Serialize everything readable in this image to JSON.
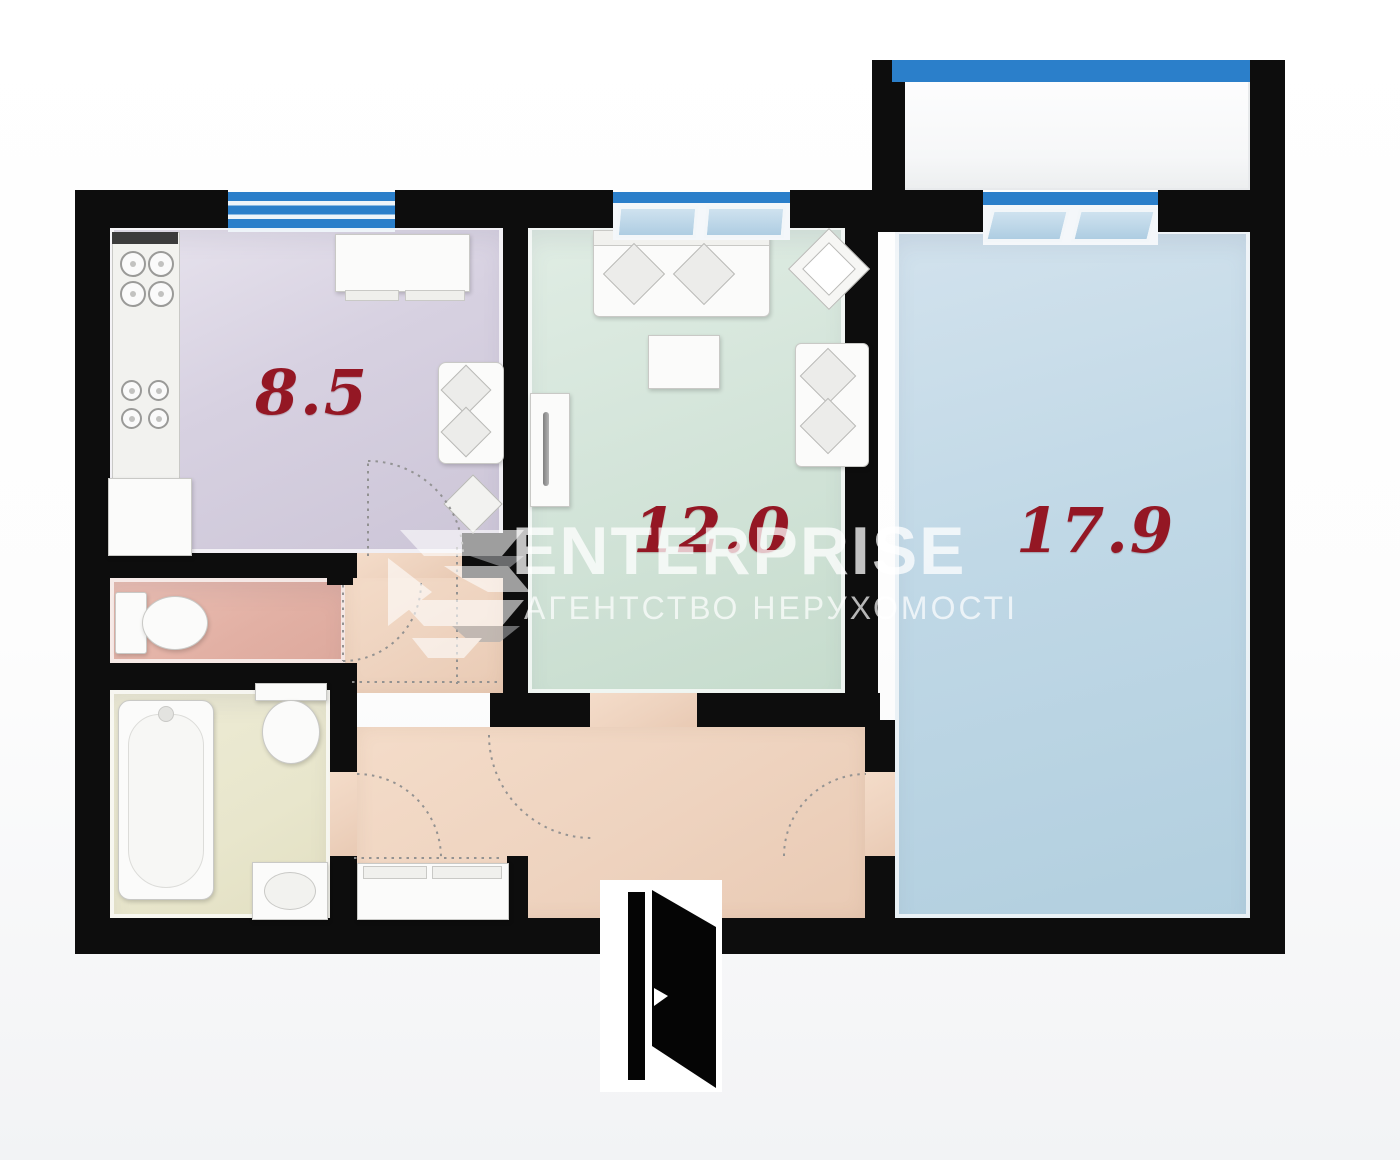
{
  "plan_type": "apartment-floor-plan",
  "rooms": {
    "kitchen": {
      "area": "8.5"
    },
    "living_room": {
      "area": "12.0"
    },
    "bedroom": {
      "area": "17.9"
    }
  },
  "watermark": {
    "title": "ENTERPRISE",
    "subtitle": "АГЕНТСТВО НЕРУХОМОСТІ"
  },
  "colors": {
    "wall": "#0d0d0d",
    "window_blue": "#2b7fca",
    "area_label_red": "#941724",
    "kitchen_floor": "#d6d0e0",
    "living_room_floor": "#d3e4d9",
    "bedroom_floor": "#bfd7e5",
    "wc_floor": "#e2b0a4",
    "bathroom_floor": "#e8e6cc",
    "hallway_floor": "#eed3bf",
    "balcony_floor": "#fbfbfc",
    "watermark_white": "#ffffff"
  },
  "icons": [
    "stove-icon",
    "cooktop-icon",
    "fridge-icon",
    "kitchen-cabinet-icon",
    "kitchen-sofa-icon",
    "kitchen-chair-icon",
    "sofa-icon",
    "armchair-icon",
    "coffee-table-icon",
    "loveseat-icon",
    "wardrobe-icon",
    "toilet-icon",
    "bidet-icon",
    "bathtub-icon",
    "sink-icon",
    "hall-wardrobe-icon",
    "entrance-door-icon",
    "window-icon",
    "balcony-glazing-icon",
    "door-swing-arc",
    "logo-icon"
  ]
}
